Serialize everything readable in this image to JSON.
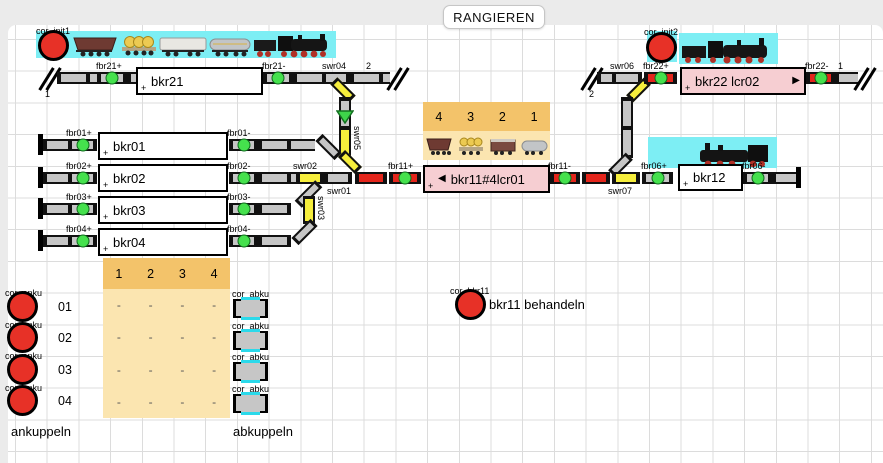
{
  "title": "RANGIEREN",
  "plus": "+",
  "arrow_left": "◀",
  "arrow_right": "▶",
  "blocks": {
    "bkr21": "bkr21",
    "bkr01": "bkr01",
    "bkr02": "bkr02",
    "bkr03": "bkr03",
    "bkr04": "bkr04",
    "bkr11": "bkr11#4lcr01",
    "bkr12": "bkr12",
    "bkr22": "bkr22 lcr02"
  },
  "signals": {
    "fbr21p": "fbr21+",
    "fbr21m": "fbr21-",
    "fbr22p": "fbr22+",
    "fbr22m": "fbr22-",
    "fbr01p": "fbr01+",
    "fbr01m": "fbr01-",
    "fbr02p": "fbr02+",
    "fbr02m": "fbr02-",
    "fbr03p": "fbr03+",
    "fbr03m": "fbr03-",
    "fbr04p": "fbr04+",
    "fbr04m": "fbr04-",
    "fbr11p": "fbr11+",
    "fbr11m": "fbr11-",
    "fbr06p": "fbr06+",
    "fbr06m": "fbr06-"
  },
  "switches": {
    "swr01": "swr01",
    "swr02": "swr02",
    "swr03": "swr03",
    "swr04": "swr04",
    "swr05": "swr05",
    "swr06": "swr06",
    "swr07": "swr07"
  },
  "connectors": {
    "left21": "1",
    "right21": "2",
    "left22": "2",
    "right22": "1"
  },
  "buttons": {
    "init1": "cor_init1",
    "init2": "cor_init2",
    "anku": "cor_anku",
    "abku": "cor_abku",
    "bkr11": "cor_bkr11"
  },
  "middle_table": {
    "headers": [
      "4",
      "3",
      "2",
      "1"
    ]
  },
  "lower_table": {
    "headers": [
      "1",
      "2",
      "3",
      "4"
    ],
    "row_labels": [
      "01",
      "02",
      "03",
      "04"
    ],
    "rows": [
      [
        "-",
        "-",
        "-",
        "-"
      ],
      [
        "-",
        "-",
        "-",
        "-"
      ],
      [
        "-",
        "-",
        "-",
        "-"
      ],
      [
        "-",
        "-",
        "-",
        "-"
      ]
    ]
  },
  "captions": {
    "ankuppeln": "ankuppeln",
    "abkuppeln": "abkuppeln",
    "bkr11_behandeln": "bkr11 behandeln"
  },
  "colors": {
    "switch_yellow": "#f6ee3c",
    "route_red": "#e4251b",
    "sensor_green": "#45e14d",
    "occupied_pink": "#f6ced2",
    "table_header_orange": "#f3c36a",
    "table_body_orange": "#fbe5b0",
    "train_bg_cyan": "#7deef4",
    "button_red": "#e73127"
  }
}
